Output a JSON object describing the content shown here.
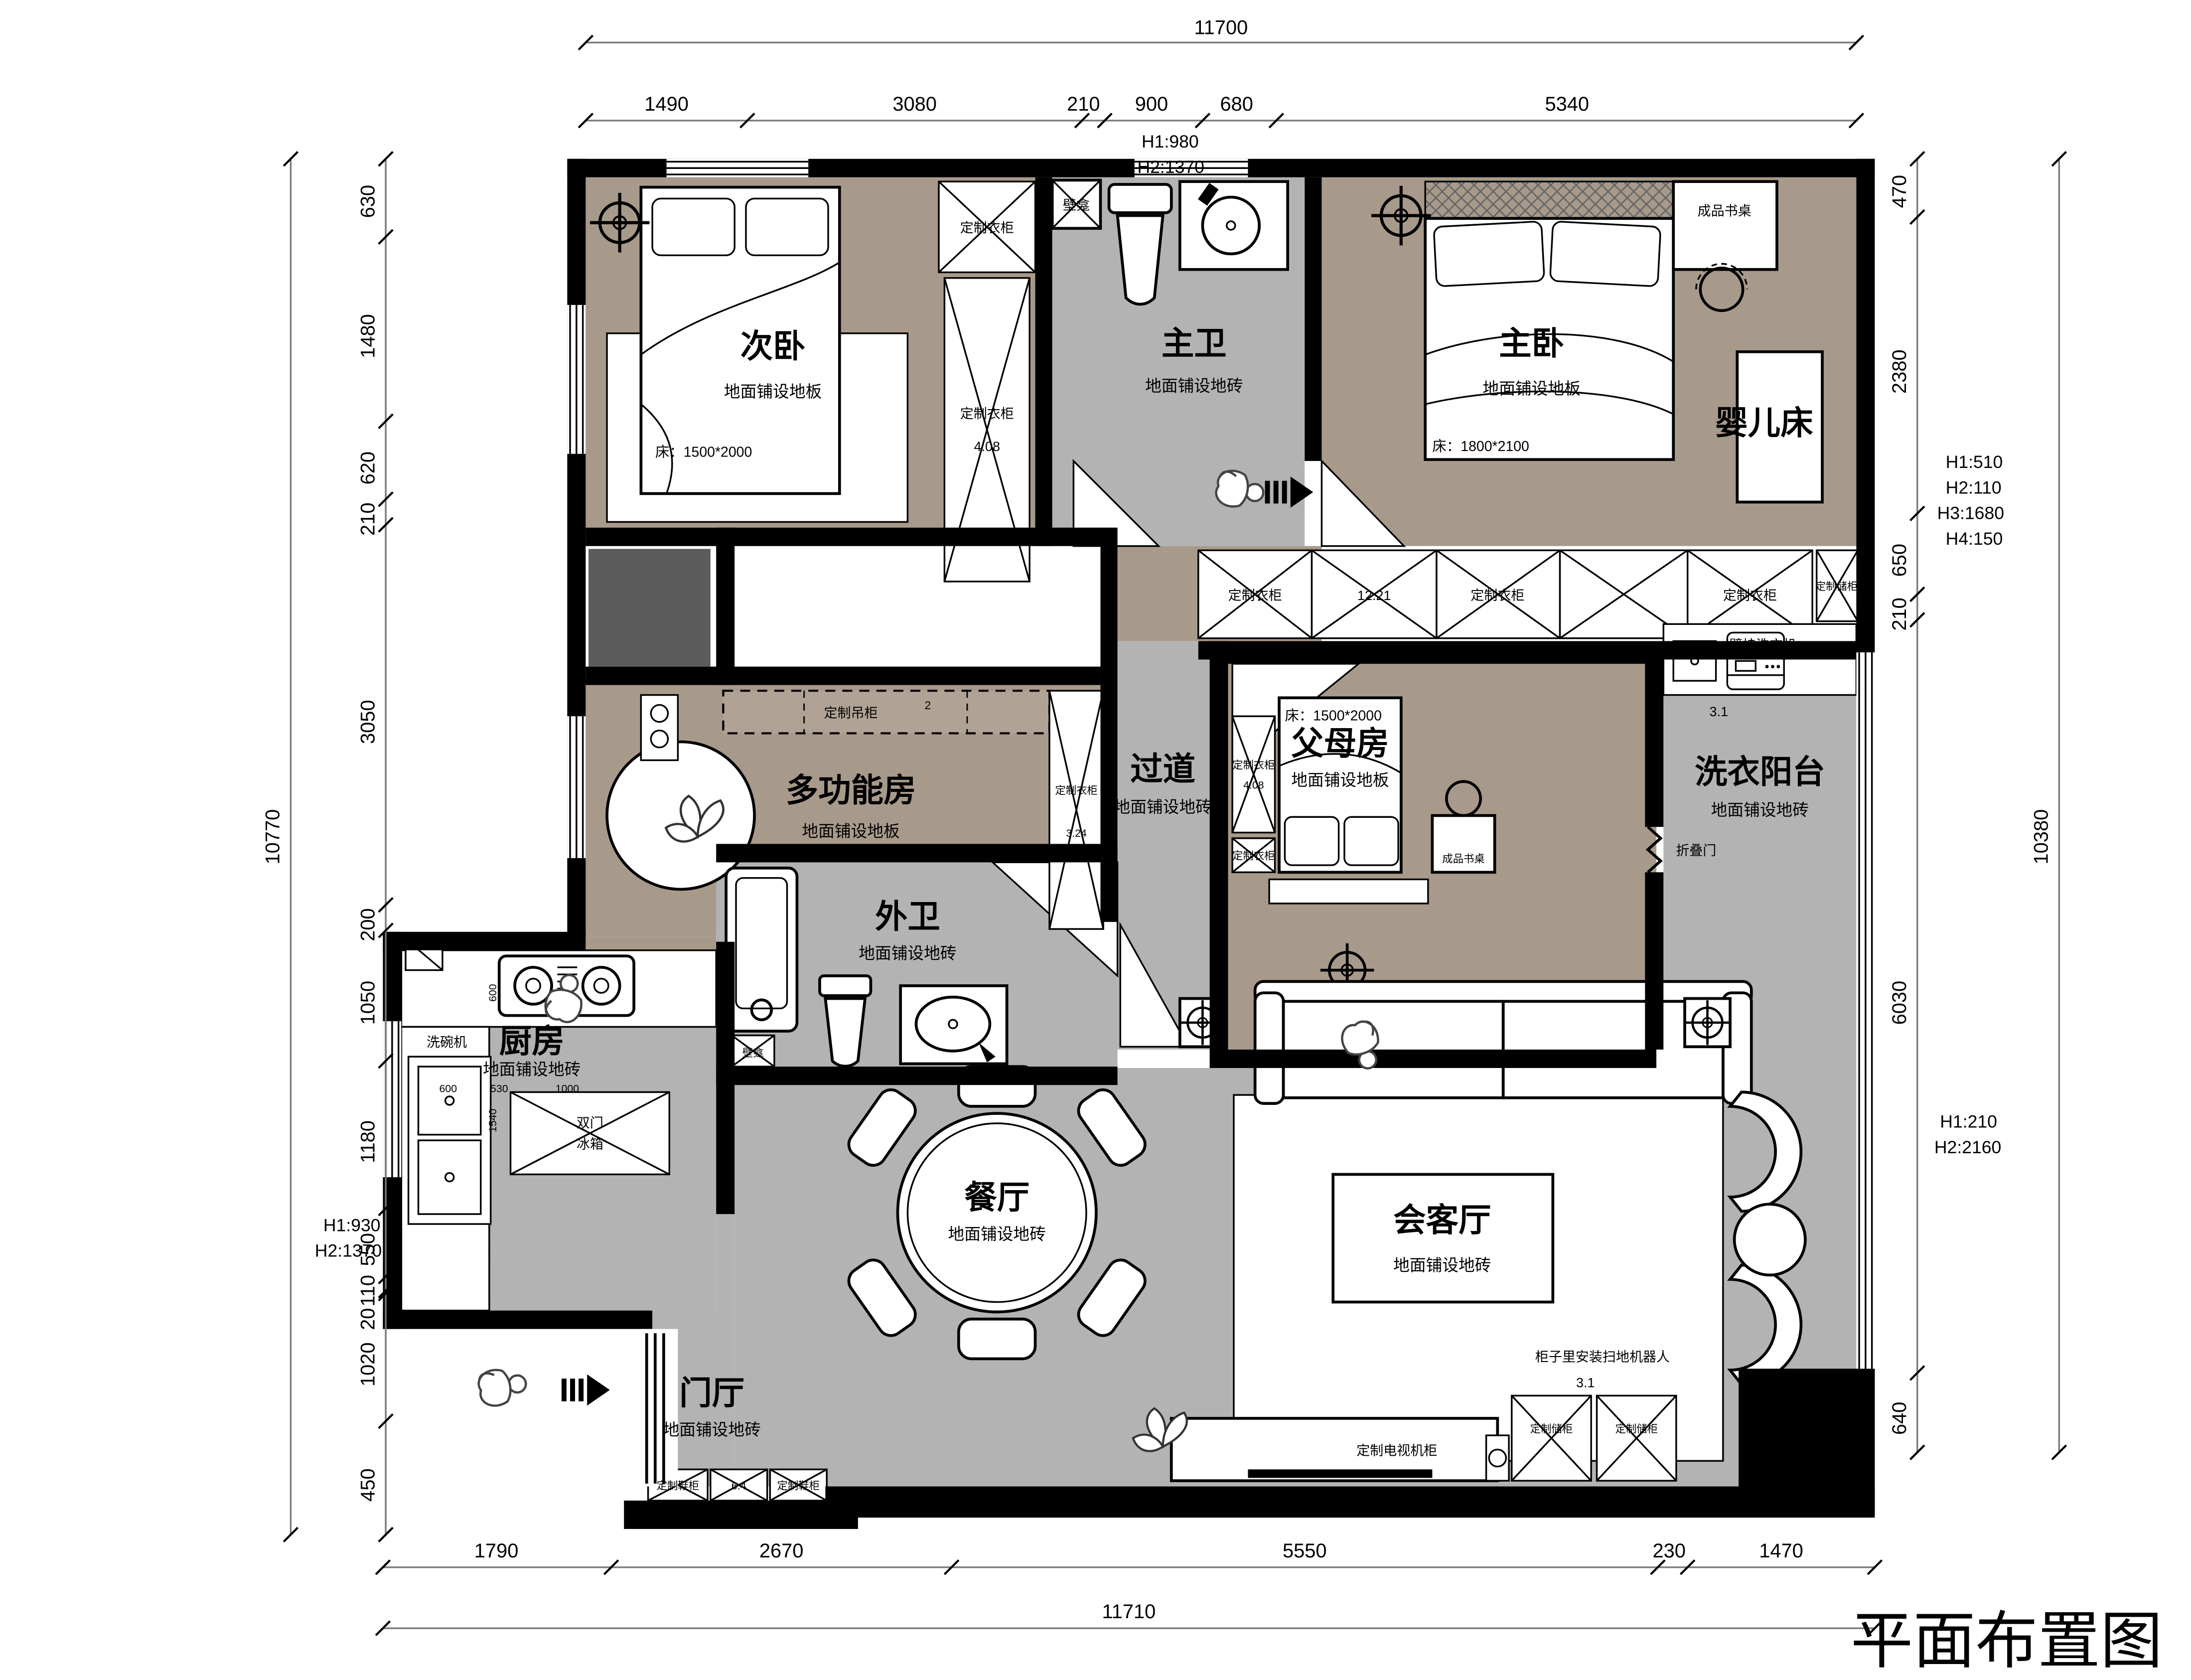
{
  "title": "平面布置图",
  "colors": {
    "wall": "#000000",
    "wood_floor": "#a89a8b",
    "tile_floor": "#b3b3b3",
    "paper": "#ffffff"
  },
  "rooms": {
    "ciwo": {
      "name": "次卧",
      "floor": "地面铺设地板"
    },
    "zhuwei": {
      "name": "主卫",
      "floor": "地面铺设地砖"
    },
    "zhuwo": {
      "name": "主卧",
      "floor": "地面铺设地板"
    },
    "duogong": {
      "name": "多功能房",
      "floor": "地面铺设地板"
    },
    "guodao": {
      "name": "过道",
      "floor": "地面铺设地砖"
    },
    "fumu": {
      "name": "父母房",
      "floor": "地面铺设地板"
    },
    "yangtai": {
      "name": "洗衣阳台",
      "floor": "地面铺设地砖"
    },
    "waiwei": {
      "name": "外卫",
      "floor": "地面铺设地砖"
    },
    "chufang": {
      "name": "厨房",
      "floor": "地面铺设地砖"
    },
    "canting": {
      "name": "餐厅",
      "floor": "地面铺设地砖"
    },
    "menting": {
      "name": "门厅",
      "floor": "地面铺设地砖"
    },
    "huiketing": {
      "name": "会客厅",
      "floor": "地面铺设地砖"
    }
  },
  "beds": {
    "bed1500": "床：1500*2000",
    "bed1800": "床：1800*2100"
  },
  "furn": {
    "wardrobe": "定制衣柜",
    "storage": "定制储柜",
    "hanging": "定制吊柜",
    "hanging_sup": "2",
    "shoe": "定制鞋柜",
    "tv_cabinet": "定制电视机柜",
    "desk": "成品书桌",
    "crib": "婴儿床",
    "niche": "壁龛",
    "wall_washer": "壁挂洗衣机",
    "folding_door": "折叠门",
    "dishwasher": "洗碗机",
    "fridge_l1": "双门",
    "fridge_l2": "冰箱",
    "robot": "柜子里安装扫地机器人"
  },
  "areas": {
    "a408": "4.08",
    "a324": "3.24",
    "a1221": "12.21",
    "a64": "6.4",
    "a31": "3.1"
  },
  "dims": {
    "top_total": "11700",
    "top": [
      "1490",
      "3080",
      "210",
      "900",
      "680",
      "5340"
    ],
    "top_h": [
      "H1:980",
      "H2:1370"
    ],
    "left_total": "10770",
    "left": [
      "630",
      "1480",
      "620",
      "210",
      "3050",
      "200",
      "1050",
      "1180",
      "550",
      "110",
      "20",
      "1020",
      "450"
    ],
    "left_h": [
      "H1:930",
      "H2:1370"
    ],
    "right_total": "10380",
    "right": [
      "470",
      "2380",
      "650",
      "210",
      "6030",
      "640"
    ],
    "right_h1": [
      "H1:510",
      "H2:110",
      "H3:1680",
      "H4:150"
    ],
    "right_h2": [
      "H1:210",
      "H2:2160"
    ],
    "bottom": [
      "1790",
      "2670",
      "5550",
      "230",
      "1470"
    ],
    "bottom_total": "11710",
    "kitchen": [
      "600",
      "1540",
      "600",
      "530",
      "1000"
    ]
  }
}
